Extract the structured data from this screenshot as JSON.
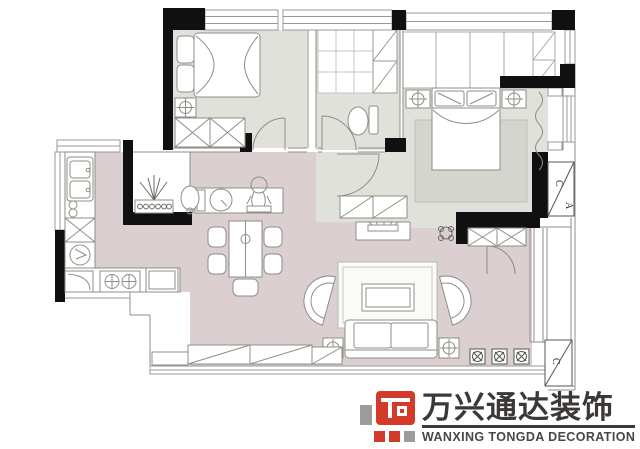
{
  "document": {
    "type": "residential floor plan drawing"
  },
  "palette": {
    "wall": "#101010",
    "floor_living": "#dccfd2",
    "floor_bedroom": "#e0e1db",
    "rug": "#d4d5cf",
    "furniture_line": "#8e8e87",
    "thin_line": "#9a9a94",
    "logo_red": "#d23a2a",
    "logo_gray": "#9c9c9c",
    "logo_text": "#3b3836"
  },
  "plan": {
    "ac_top": {
      "letter_c": "C",
      "letter_a": "A"
    },
    "ac_bottom": {
      "letter_c": "C"
    },
    "rooms": [
      "bedroom",
      "bathroom",
      "master-bedroom",
      "closet",
      "kitchen",
      "dining",
      "living",
      "entry",
      "balcony"
    ]
  },
  "watermark": {
    "cn": "万兴通达装饰",
    "en": "WANXING TONGDA DECORATION"
  }
}
